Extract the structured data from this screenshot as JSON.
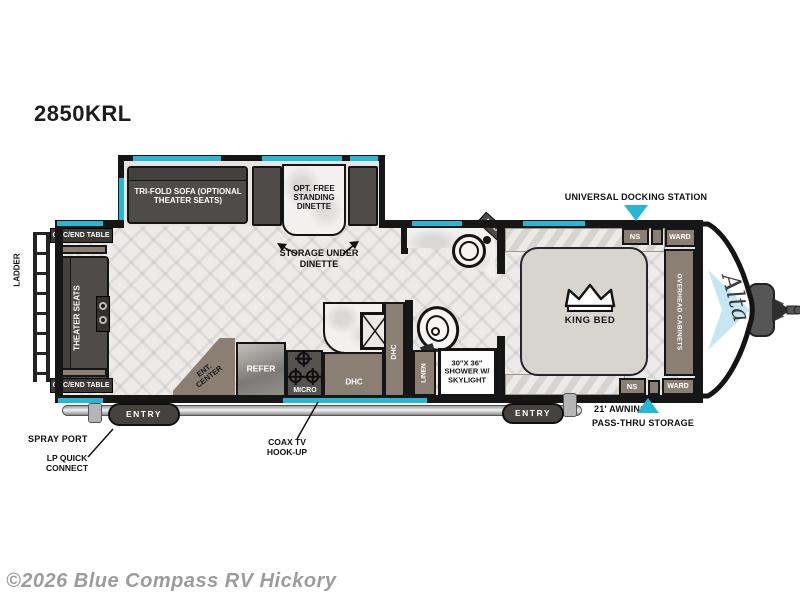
{
  "model": "2850KRL",
  "watermark": "©2026 Blue Compass RV Hickory",
  "brand": {
    "logo": "Alta"
  },
  "colors": {
    "accent": "#25b7d3",
    "wall": "#161616",
    "furniture": "#4f4b48",
    "cabinet": "#8b7f74"
  },
  "slideout": {
    "sofa": "TRI-FOLD SOFA (OPTIONAL THEATER SEATS)",
    "dinette": "OPT. FREE STANDING DINETTE"
  },
  "living": {
    "ohc_table_top": "OHC/END TABLE",
    "ohc_table_bottom": "OHC/END TABLE",
    "theater_seats": "THEATER SEATS",
    "ladder": "LADDER",
    "ent_center": "ENT. CENTER"
  },
  "kitchen": {
    "refer": "REFER",
    "micro": "MICRO",
    "dhc_counter": "DHC",
    "dhc_tall": "DHC"
  },
  "bath": {
    "linen": "LINEN",
    "shower": "30\"X 36\" SHOWER W/ SKYLIGHT",
    "med": "MED"
  },
  "bedroom": {
    "king_bed": "KING BED",
    "ns_top": "NS",
    "ns_bottom": "NS",
    "ward_top": "WARD",
    "ward_bottom": "WARD",
    "overhead_cabinets": "OVERHEAD CABINETS"
  },
  "entries": {
    "left": "ENTRY",
    "right": "ENTRY"
  },
  "callouts": {
    "docking": "UNIVERSAL DOCKING STATION",
    "storage_under_dinette": "STORAGE UNDER DINETTE",
    "coax": "COAX TV HOOK-UP",
    "spray_port": "SPRAY PORT",
    "lp_quick_connect": "LP QUICK CONNECT",
    "awning": "21' AWNING",
    "pass_thru": "PASS-THRU STORAGE"
  }
}
